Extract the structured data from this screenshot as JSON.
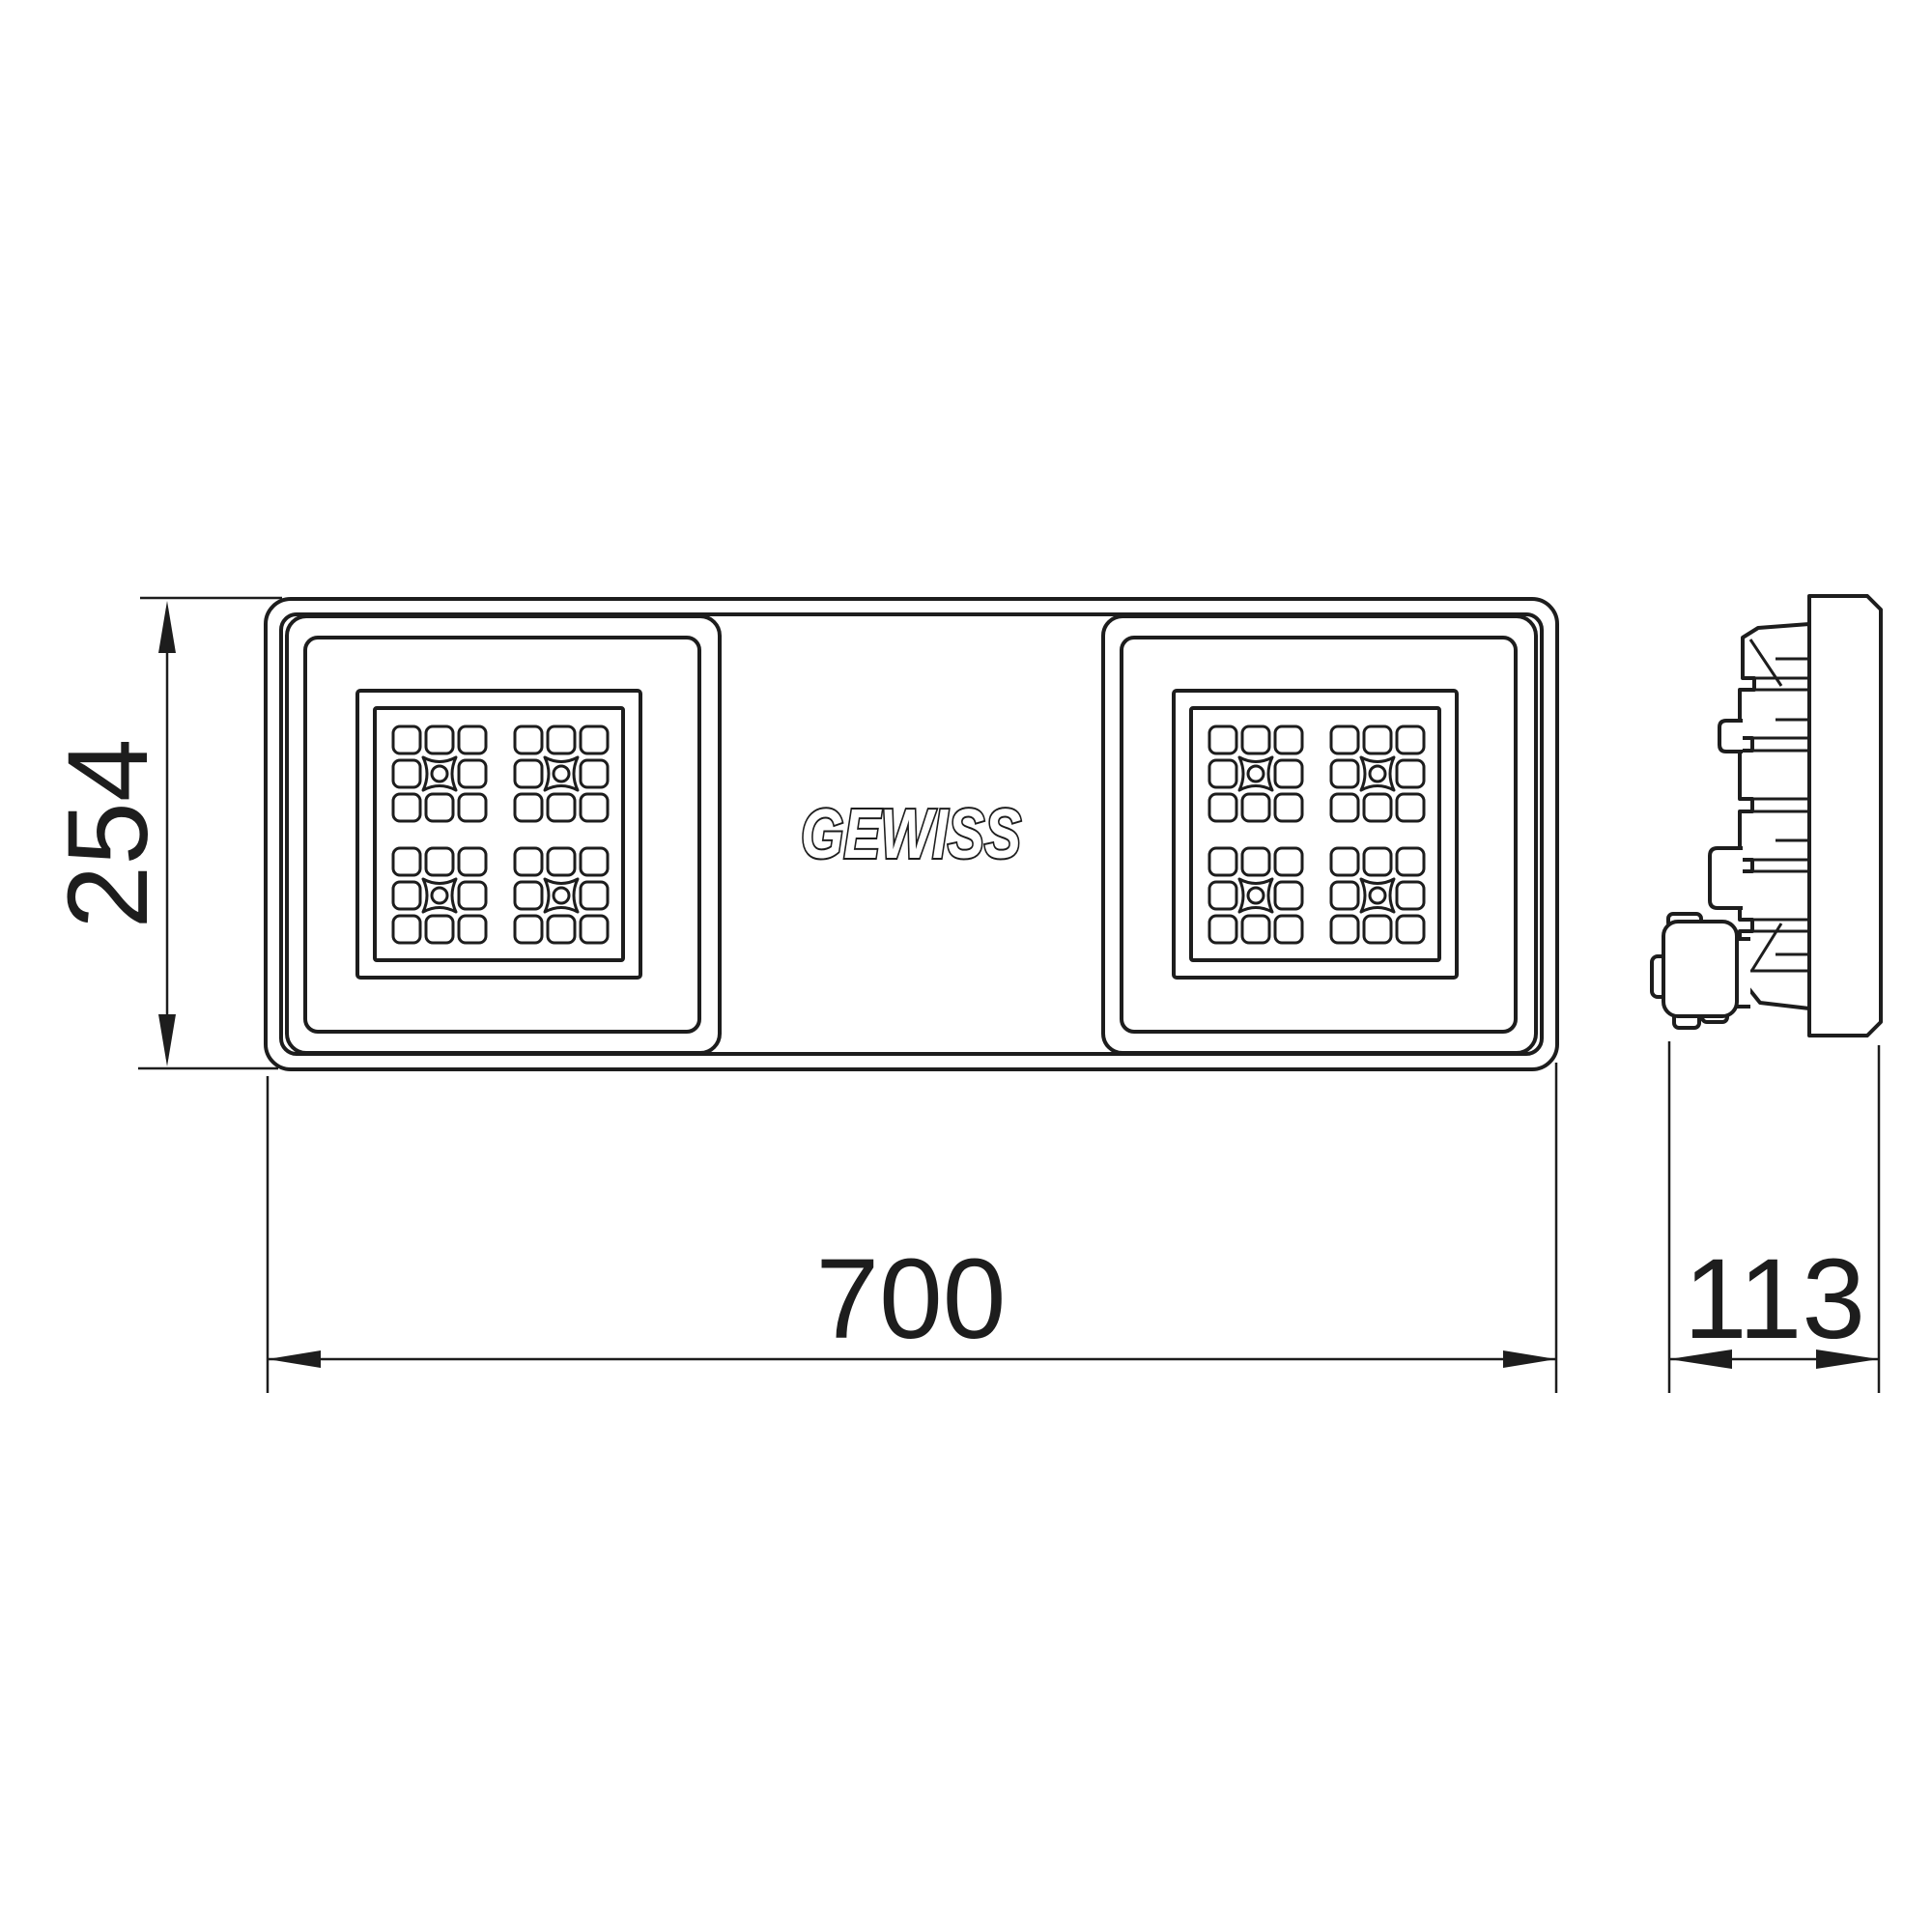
{
  "drawing": {
    "type": "technical-dimension-drawing",
    "product": "LED floodlight",
    "brand_logo": "GEWISS",
    "line_color": "#1d1d1d",
    "background_color": "#ffffff",
    "views": {
      "front_view": "front elevation with two square LED modules, each with 4 LED clusters",
      "side_view": "side profile with heatsink fins and cable gland"
    },
    "dimensions": {
      "height": {
        "value": "254",
        "orientation": "vertical",
        "side": "left"
      },
      "width": {
        "value": "700",
        "orientation": "horizontal",
        "side": "bottom"
      },
      "depth": {
        "value": "113",
        "orientation": "horizontal",
        "side": "bottom-right"
      }
    }
  }
}
